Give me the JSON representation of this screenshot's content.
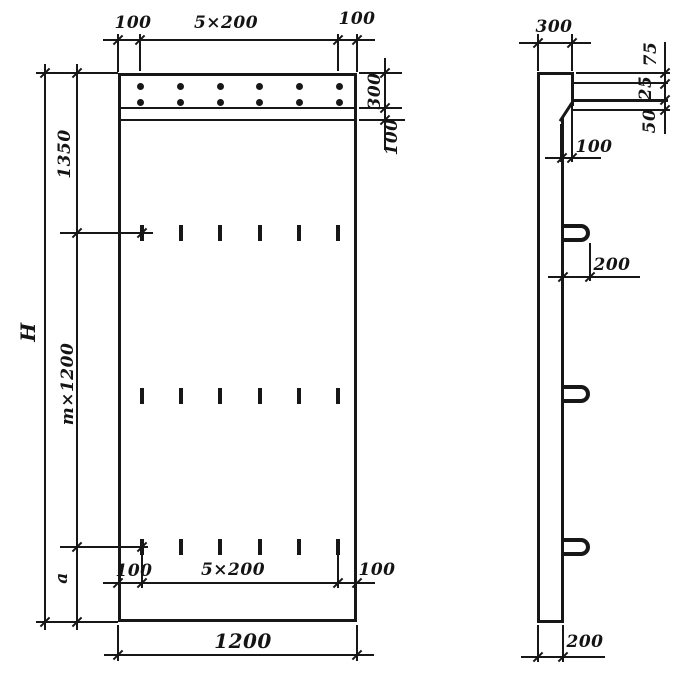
{
  "style": {
    "ink": "#171717",
    "paper": "#ffffff"
  },
  "front": {
    "top_dims": [
      "100",
      "5×200",
      "100"
    ],
    "right_dims": [
      "300",
      "100"
    ],
    "left_dims": {
      "overall": "H",
      "upper": "1350",
      "middle": "m×1200",
      "lower": "a"
    },
    "inner_bottom_dims": [
      "100",
      "5×200",
      "100"
    ],
    "bottom_dim": "1200"
  },
  "side": {
    "top_dim": "300",
    "right_dims": [
      "75",
      "25",
      "50"
    ],
    "step_dim": "100",
    "hook_dim": "200",
    "bottom_dim": "200"
  }
}
